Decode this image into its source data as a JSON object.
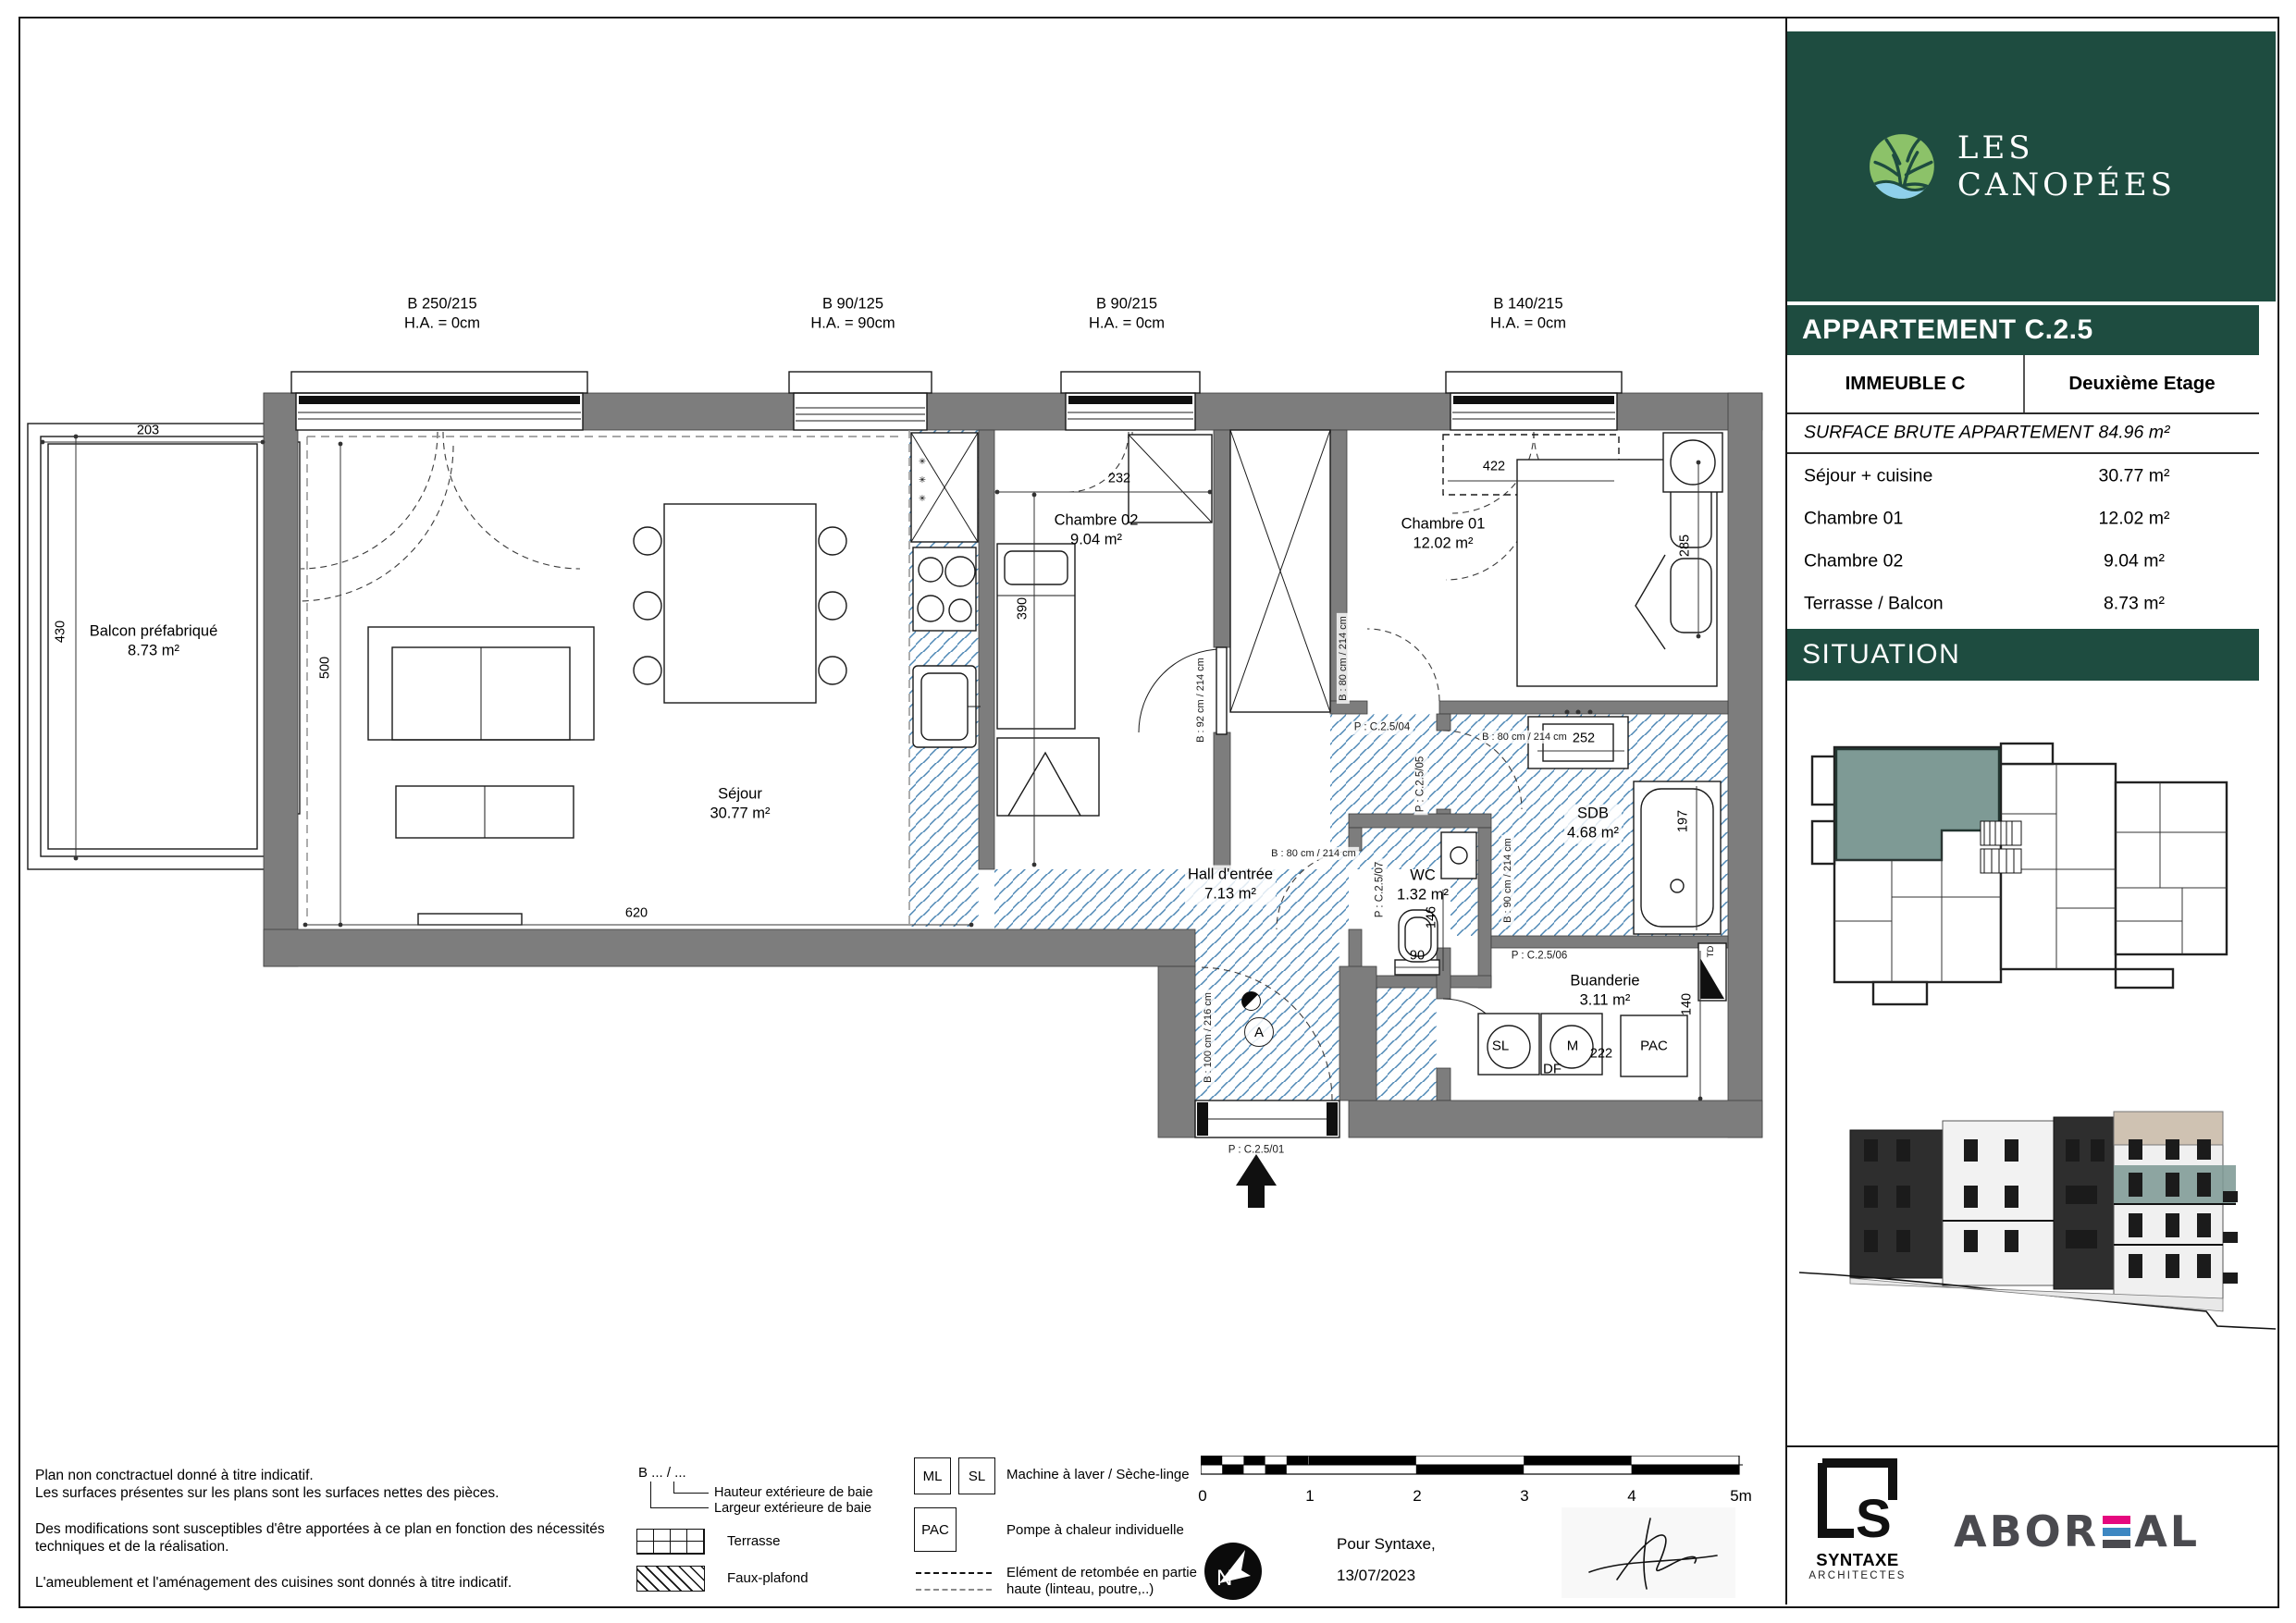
{
  "colors": {
    "dark_green": "#1e4c40",
    "teal": "#7e9a95",
    "hatch": "#4d87b5",
    "wall": "#7d7d7d",
    "pink": "#e5087e",
    "ablue": "#3d87c2",
    "tan": "#cfc2b2",
    "logo_leaf": "#8cc269",
    "logo_water": "#8ed0ea"
  },
  "sidebar": {
    "logo_text": "LES CANOPÉES",
    "title": "APPARTEMENT C.2.5",
    "immeuble": "IMMEUBLE C",
    "etage": "Deuxième Etage",
    "surface_label": "SURFACE BRUTE APPARTEMENT",
    "surface_value": "84.96 m²",
    "rows": [
      {
        "label": "Séjour + cuisine",
        "value": "30.77 m²"
      },
      {
        "label": "Chambre 01",
        "value": "12.02 m²"
      },
      {
        "label": "Chambre 02",
        "value": "9.04 m²"
      },
      {
        "label": "Terrasse / Balcon",
        "value": "8.73 m²"
      }
    ],
    "situation": "SITUATION"
  },
  "plan": {
    "windows": [
      {
        "l1": "B 250/215",
        "l2": "H.A. = 0cm"
      },
      {
        "l1": "B 90/125",
        "l2": "H.A. = 90cm"
      },
      {
        "l1": "B 90/215",
        "l2": "H.A. = 0cm"
      },
      {
        "l1": "B 140/215",
        "l2": "H.A. = 0cm"
      }
    ],
    "rooms": {
      "balcon": {
        "n": "Balcon préfabriqué",
        "a": "8.73 m²"
      },
      "sejour": {
        "n": "Séjour",
        "a": "30.77 m²"
      },
      "chambre02": {
        "n": "Chambre 02",
        "a": "9.04 m²"
      },
      "chambre01": {
        "n": "Chambre 01",
        "a": "12.02 m²"
      },
      "hall": {
        "n": "Hall d'entrée",
        "a": "7.13 m²"
      },
      "wc": {
        "n": "WC",
        "a": "1.32 m²"
      },
      "sdb": {
        "n": "SDB",
        "a": "4.68 m²"
      },
      "buanderie": {
        "n": "Buanderie",
        "a": "3.11 m²"
      }
    },
    "dims": {
      "d203": "203",
      "d430": "430",
      "d500": "500",
      "d620": "620",
      "d232": "232",
      "d390": "390",
      "d422": "422",
      "d285": "285",
      "d252": "252",
      "d197": "197",
      "d146": "146",
      "d90": "90",
      "d140": "140",
      "d222": "222"
    },
    "doors": {
      "p01": "P : C.2.5/01",
      "p04": "P : C.2.5/04",
      "p05": "P : C.2.5/05",
      "p06": "P : C.2.5/06",
      "p07": "P : C.2.5/07"
    },
    "bays": {
      "b100": "B : 100 cm / 216 cm",
      "b80": "B : 80 cm / 214 cm",
      "b90": "B : 90 cm / 214 cm",
      "b92": "B : 92 cm / 214 cm"
    },
    "equipment": {
      "sl": "SL",
      "ml": "M",
      "df": "DF",
      "pac": "PAC",
      "td": "TD",
      "star": "✳"
    },
    "annot": {
      "a": "A"
    }
  },
  "legend": {
    "bay_code": "B ... / ...",
    "hauteur": "Hauteur extérieure de baie",
    "largeur": "Largeur extérieure de baie",
    "terrasse": "Terrasse",
    "faux_plafond": "Faux-plafond",
    "ml": "ML",
    "sl": "SL",
    "ml_sl_label": "Machine à laver / Sèche-linge",
    "pac": "PAC",
    "pac_label": "Pompe à chaleur individuelle",
    "retombee_line1": "Elément de retombée en partie",
    "retombee_line2": "haute (linteau, poutre,..)"
  },
  "footer": {
    "disclaimer1": "Plan non conctractuel donné à titre indicatif.",
    "disclaimer2": "Les surfaces présentes sur les plans sont les surfaces nettes des pièces.",
    "disclaimer3": "Des modifications sont susceptibles d'être apportées à ce plan en fonction des nécessités techniques et de la réalisation.",
    "disclaimer4": "L'ameublement et l'aménagement des cuisines sont donnés à titre indicatif.",
    "scale_ticks": [
      "0",
      "1",
      "2",
      "3",
      "4",
      "5m"
    ],
    "north": "N",
    "for_text": "Pour Syntaxe,",
    "date": "13/07/2023",
    "syntaxe_s": "S",
    "syntaxe_name": "SYNTAXE",
    "syntaxe_sub": "ARCHITECTES",
    "aboreal_left": "ABOR",
    "aboreal_right": "AL"
  }
}
